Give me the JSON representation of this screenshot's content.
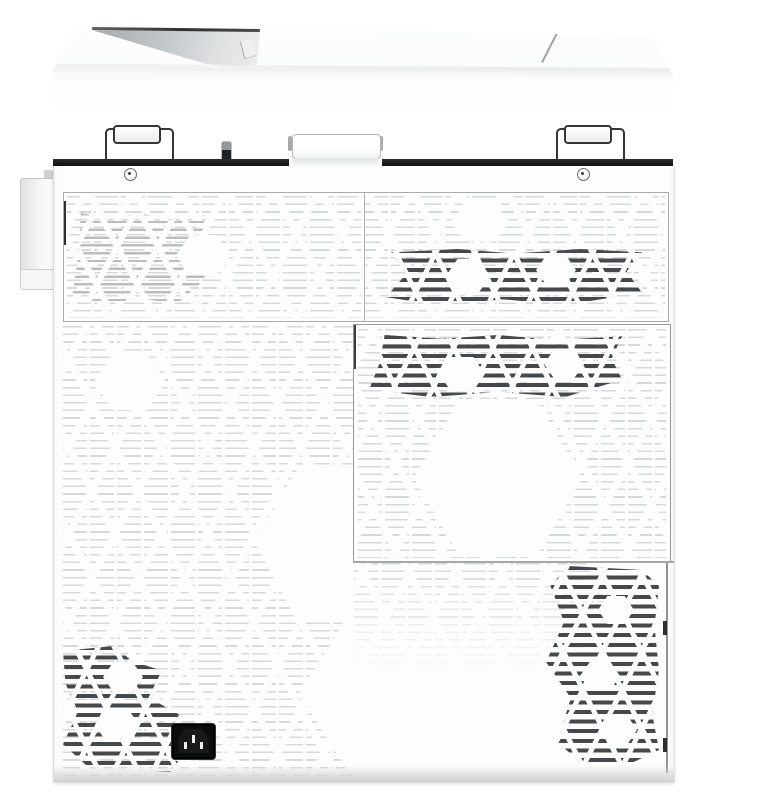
{
  "meta": {
    "title": "White multifunction printer — rear view product photo",
    "type": "product-photo"
  },
  "parts": {
    "top_cover": {
      "label": "Top cover with output tray opening"
    },
    "output_notch": {
      "label": "Output tray opening"
    },
    "lid_seam": {
      "label": "Top cover seam"
    },
    "left_hinge": {
      "label": "Scanner lid hinge (left)"
    },
    "right_hinge": {
      "label": "Scanner lid hinge (right)"
    },
    "handle": {
      "label": "Rear lift handle"
    },
    "latch_slot": {
      "label": "Rear latch slot"
    },
    "left_screw": {
      "label": "Screw (left)"
    },
    "right_screw": {
      "label": "Screw (right)"
    },
    "side_connector": {
      "label": "Left side connector housing"
    },
    "top_vent": {
      "label": "Upper rear vent panel"
    },
    "mid_vent": {
      "label": "Middle rear vent door"
    },
    "lower_panel": {
      "label": "Lower rear panel"
    },
    "power_inlet": {
      "label": "AC power inlet (IEC C14)"
    }
  },
  "colors": {
    "background": "#ffffff",
    "body": "#fdfdfe",
    "panel_line": "#9b9d9e",
    "gap_shadow": "#1b1b1b",
    "vent_faint": "#d9dbdd",
    "vent_dark": "#45494c",
    "notch_deep": "#a8abad",
    "power_inlet": "#0b0c0c",
    "base_shadow": "#d6d7d8"
  }
}
